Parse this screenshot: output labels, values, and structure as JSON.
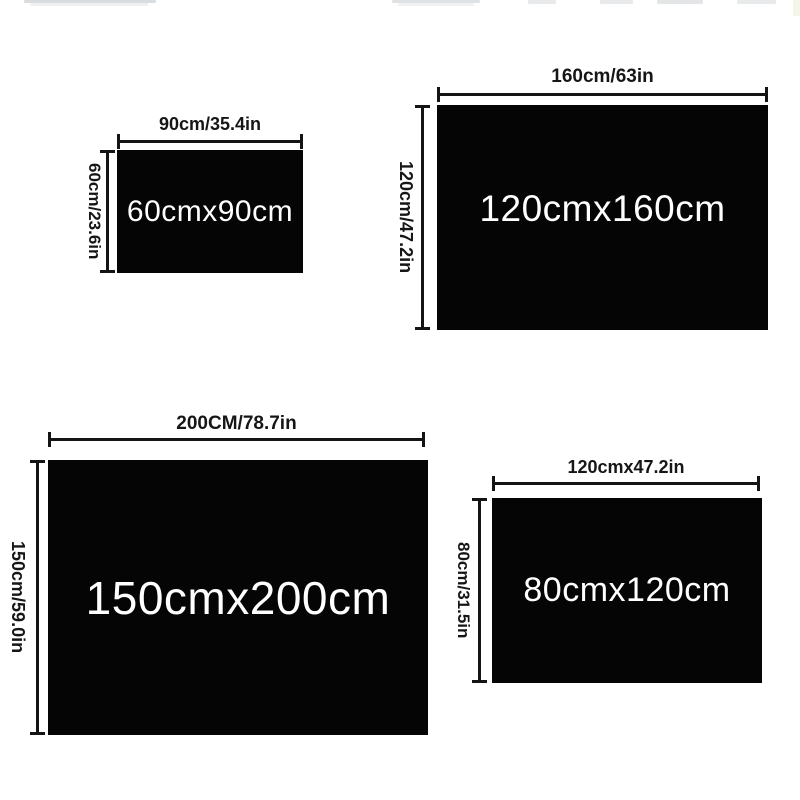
{
  "diagram": {
    "panels": {
      "p1": {
        "size_text": "60cmx90cm",
        "width_label": "90cm/35.4in",
        "height_label": "60cm/23.6in"
      },
      "p2": {
        "size_text": "120cmx160cm",
        "width_label": "160cm/63in",
        "height_label": "120cm/47.2in"
      },
      "p3": {
        "size_text": "150cmx200cm",
        "width_label": "200CM/78.7in",
        "height_label": "150cm/59.0in"
      },
      "p4": {
        "size_text": "80cmx120cm",
        "width_label": "120cmx47.2in",
        "height_label": "80cm/31.5in"
      }
    },
    "colors": {
      "background": "#ffffff",
      "rect_fill": "#050505",
      "dimension_ink": "#141414",
      "size_text_color": "#ffffff"
    }
  }
}
